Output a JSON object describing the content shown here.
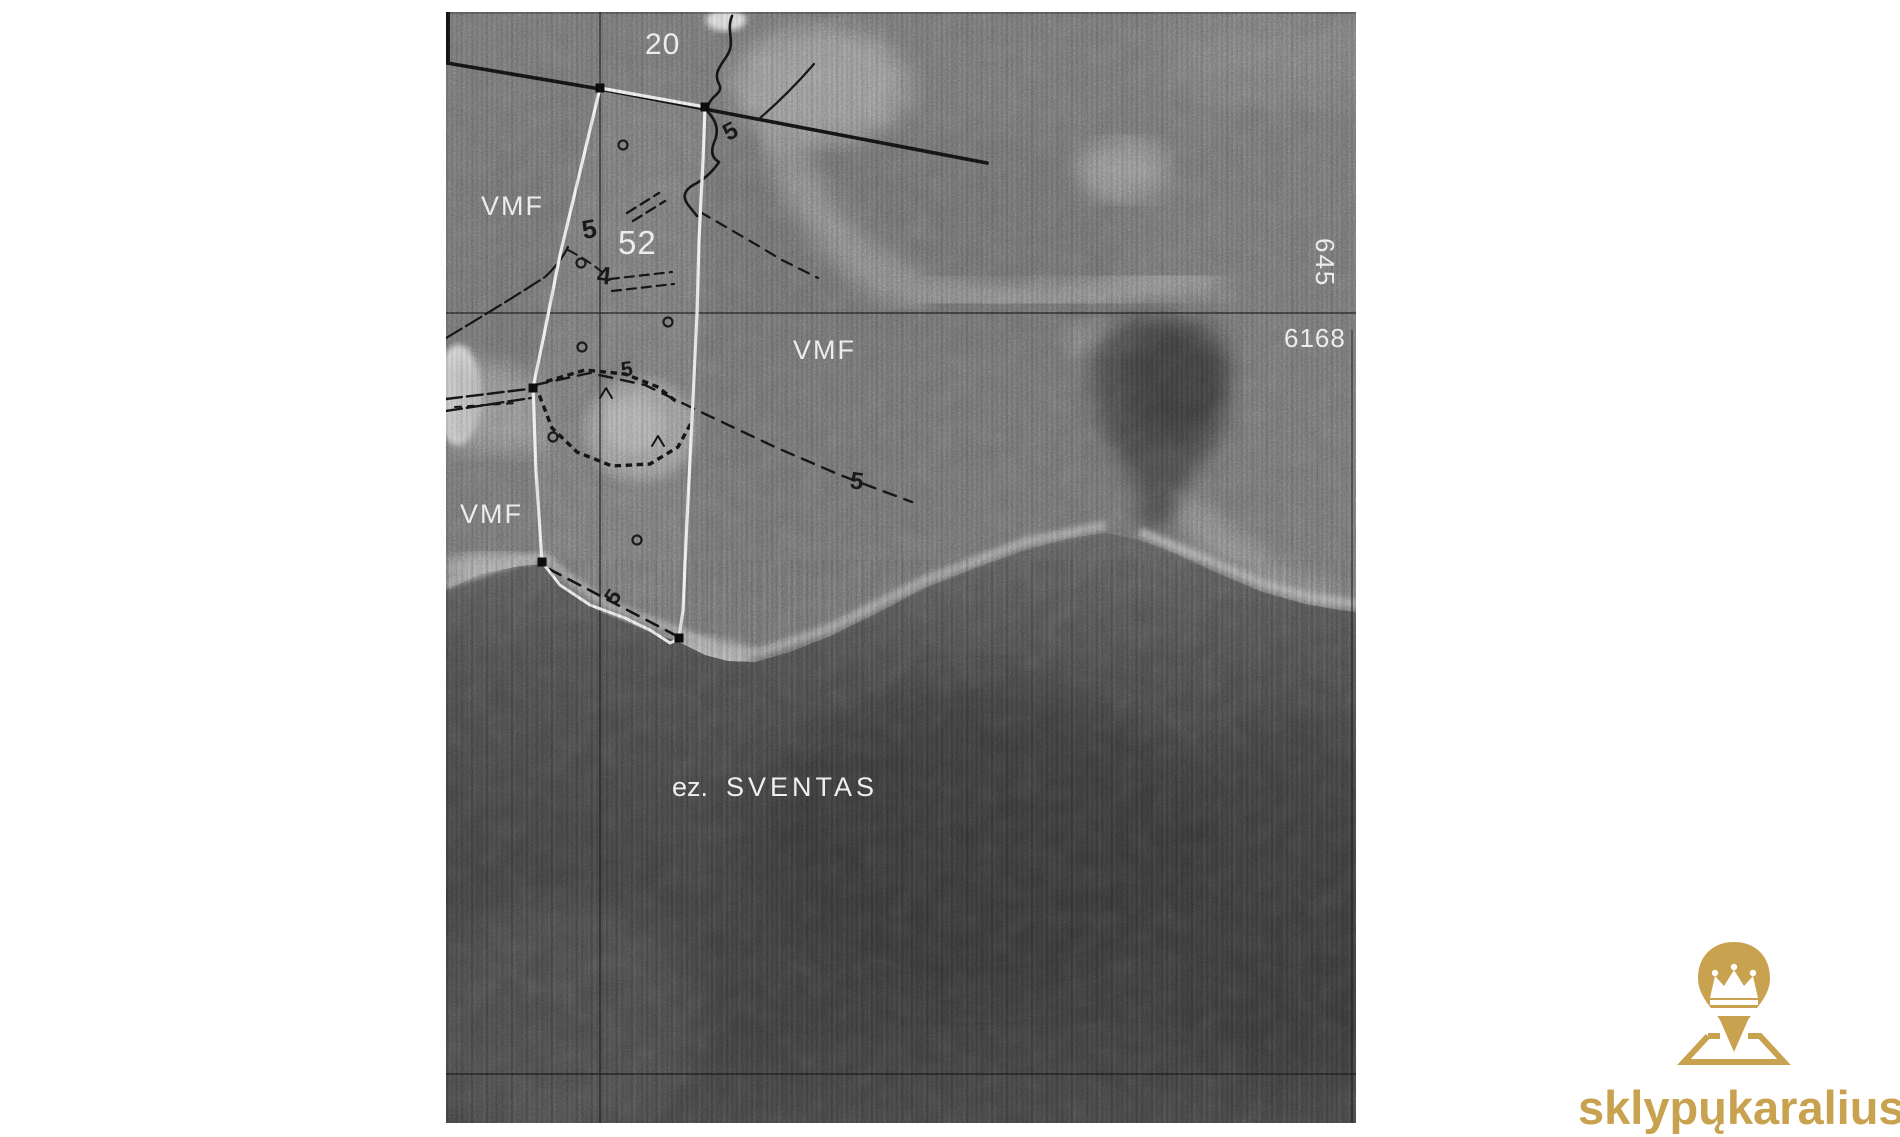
{
  "page": {
    "background": "#ffffff",
    "width": 1900,
    "height": 1137
  },
  "map": {
    "type": "grayscale-aerial-photo-with-cadastral-overlay",
    "block_labels": {
      "north": "20",
      "parcel": "52"
    },
    "forest_labels": [
      "VMF",
      "VMF",
      "VMF"
    ],
    "grid_labels": {
      "easting_vertical": "645",
      "northing_horizontal": "6168"
    },
    "lake_label": {
      "abbr": "ez.",
      "name": "SVENTAS"
    },
    "path_labels": [
      "5",
      "4",
      "5",
      "5",
      "5",
      "5"
    ],
    "colors": {
      "land": "#6f6f6f",
      "lake_deep": "#3a3a3a",
      "boundary_white": "#efefef",
      "overlay_black": "#141414"
    }
  },
  "watermark": {
    "text": "sklypųkaralius.lt",
    "color": "#c8a24e",
    "icon": "map-pin-crown-icon"
  }
}
